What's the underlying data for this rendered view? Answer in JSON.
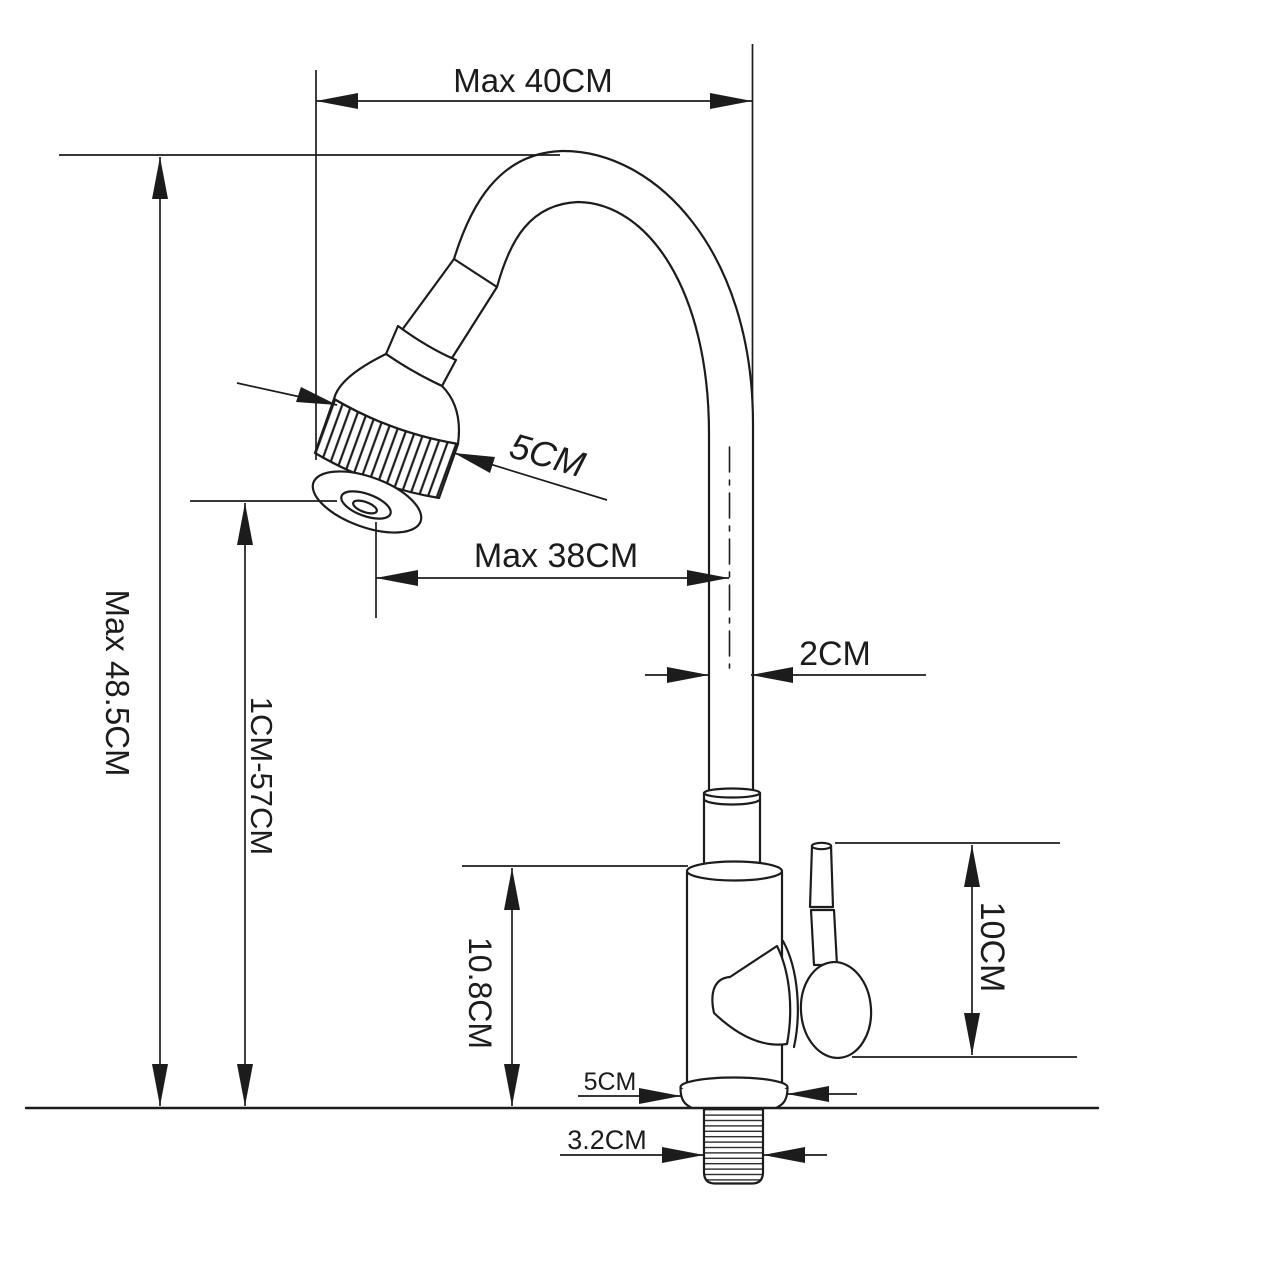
{
  "diagram": {
    "background": "#ffffff",
    "line_color": "#1c1c1c",
    "labels": {
      "top_width": "Max 40CM",
      "overall_height": "Max 48.5CM",
      "outlet_height_range": "1CM-57CM",
      "sprayer_diameter": "5CM",
      "spout_reach": "Max 38CM",
      "tube_diameter": "2CM",
      "body_height": "10.8CM",
      "handle_height": "10CM",
      "base_width": "5CM",
      "thread_diameter": "3.2CM"
    }
  }
}
